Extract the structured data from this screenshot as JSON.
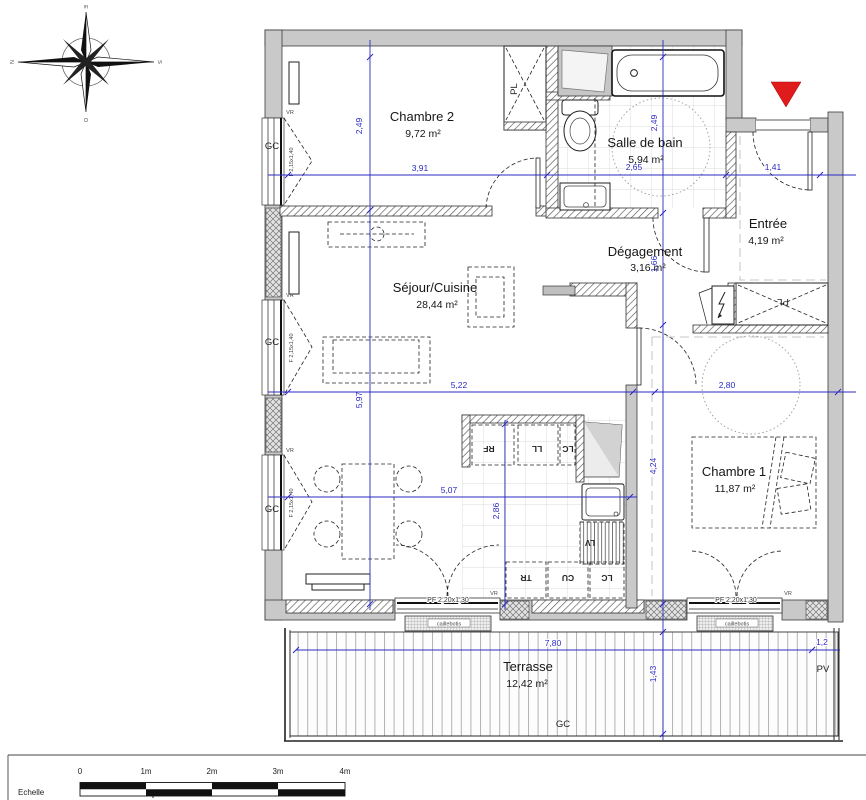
{
  "compass": {
    "top": "E",
    "right": "S",
    "bottom": "O",
    "left": "N"
  },
  "rooms": {
    "chambre2": {
      "name": "Chambre 2",
      "area": "9,72 m²"
    },
    "salle_bain": {
      "name": "Salle de bain",
      "area": "5,94 m²"
    },
    "entree": {
      "name": "Entrée",
      "area": "4,19 m²"
    },
    "degagement": {
      "name": "Dégagement",
      "area": "3,16 m²"
    },
    "sejour": {
      "name": "Séjour/Cuisine",
      "area": "28,44 m²"
    },
    "chambre1": {
      "name": "Chambre 1",
      "area": "11,87 m²"
    },
    "terrasse": {
      "name": "Terrasse",
      "area": "12,42 m²"
    }
  },
  "dimensions": {
    "chambre2_width": "3,91",
    "bain_width": "2,65",
    "entree_width": "1,41",
    "chambre2_height": "2,49",
    "sejour_height": "5,97",
    "bain_height": "2,49",
    "degagement_height": "1,66",
    "chambre1_height": "4,24",
    "sejour_width": "5,22",
    "chambre1_width": "2,80",
    "dining_width": "5,07",
    "cuisine_height": "2,86",
    "terrasse_width": "7,80",
    "terrasse_depth": "1,43",
    "terrasse_side": "1,2"
  },
  "labels": {
    "gc": "GC",
    "pl": "PL",
    "pv": "PV",
    "vr": "VR",
    "rf": "RF",
    "ll": "LL",
    "lc": "LC",
    "tr": "TR",
    "cu": "CU",
    "lv": "LV",
    "seuil": "SEUIL",
    "caillebotis": "caillebotis",
    "window_pf": "PF 2,20x1,30",
    "window_f": "F 2,15x1,40"
  },
  "scale_bar": {
    "label": "Echelle",
    "ticks": [
      "0",
      "1m",
      "2m",
      "3m",
      "4m"
    ]
  },
  "colors": {
    "dimension": "#2a2ac2",
    "wall_fill": "#c9c9c9",
    "entrance_marker": "#e01b1b"
  }
}
